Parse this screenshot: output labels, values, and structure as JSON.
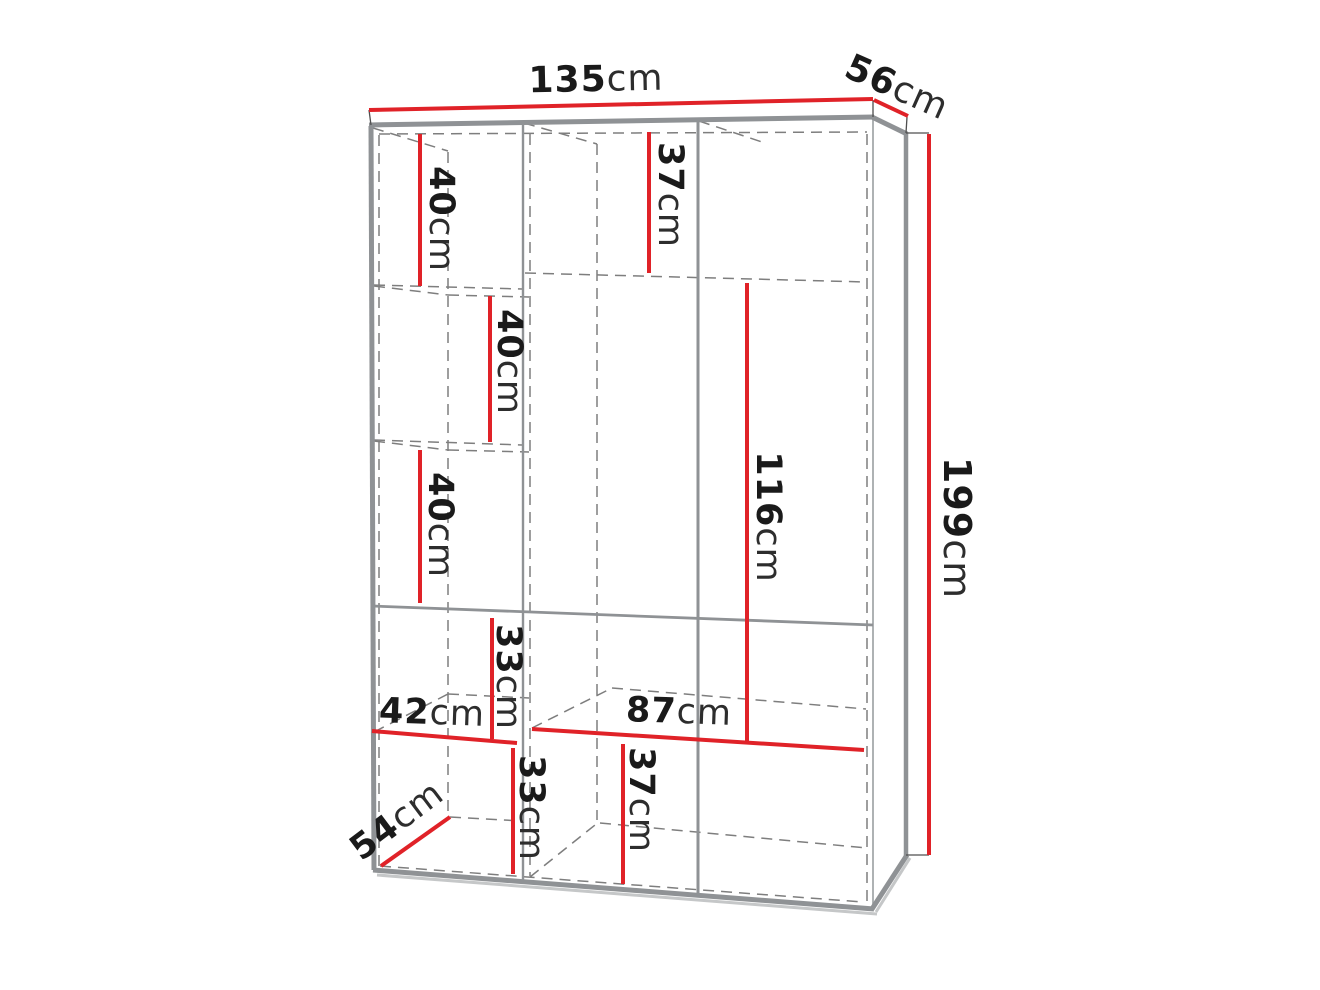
{
  "diagram": {
    "type": "furniture-dimension-diagram",
    "subject": "wardrobe with shelves, hanging space and drawers, drawn in perspective",
    "unit": "cm",
    "colors": {
      "dimension_line": "#e02228",
      "frame": "#8f9295",
      "hidden_edge_dashed": "#7e7e7e",
      "label_number": "#1a1a1a",
      "label_unit": "#2d2d2d",
      "background": "#ffffff"
    },
    "dimensions": {
      "overall_width": {
        "value": "135",
        "unit": "cm"
      },
      "overall_depth": {
        "value": "56",
        "unit": "cm"
      },
      "overall_height": {
        "value": "199",
        "unit": "cm"
      },
      "left_shelf_top": {
        "value": "40",
        "unit": "cm"
      },
      "left_shelf_middle": {
        "value": "40",
        "unit": "cm"
      },
      "left_shelf_lower": {
        "value": "40",
        "unit": "cm"
      },
      "top_compartment_height": {
        "value": "37",
        "unit": "cm"
      },
      "hanging_space_height": {
        "value": "116",
        "unit": "cm"
      },
      "mid_left_compartment": {
        "value": "33",
        "unit": "cm"
      },
      "left_section_width": {
        "value": "42",
        "unit": "cm"
      },
      "right_section_width": {
        "value": "87",
        "unit": "cm"
      },
      "bottom_left_compartment": {
        "value": "33",
        "unit": "cm"
      },
      "bottom_mid_compartment": {
        "value": "37",
        "unit": "cm"
      },
      "bottom_compartment_depth": {
        "value": "54",
        "unit": "cm"
      }
    }
  }
}
